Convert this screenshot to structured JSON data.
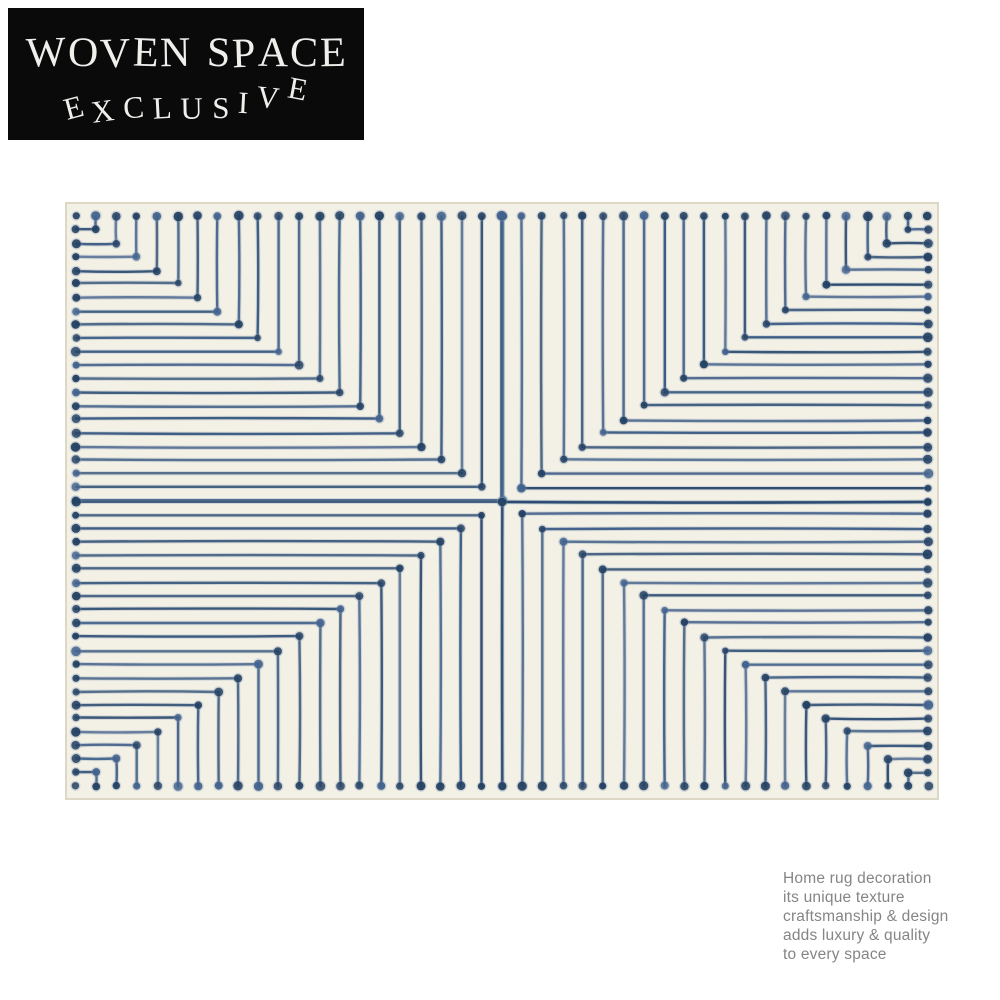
{
  "page": {
    "background_color": "#ffffff"
  },
  "brand": {
    "name": "WOVEN SPACE",
    "tagline": "EXCLUSIVE",
    "bg_color": "#0a0a0a",
    "text_color": "#f0efec"
  },
  "rug": {
    "pattern": "nested right-angle lines with dots at ends and elbows, mirrored in four quadrants around a center cross",
    "base_color": "#f3f0e5",
    "edge_color": "#ddd7c5",
    "line_color": "#2e4d73",
    "line_halo_color": "#7d96b5",
    "dot_color": "#223f60",
    "lines_per_quadrant": 21
  },
  "caption": {
    "text_color": "#858585",
    "lines": [
      "Home rug decoration",
      "its unique texture",
      "craftsmanship & design",
      "adds luxury & quality",
      "to every space"
    ]
  }
}
